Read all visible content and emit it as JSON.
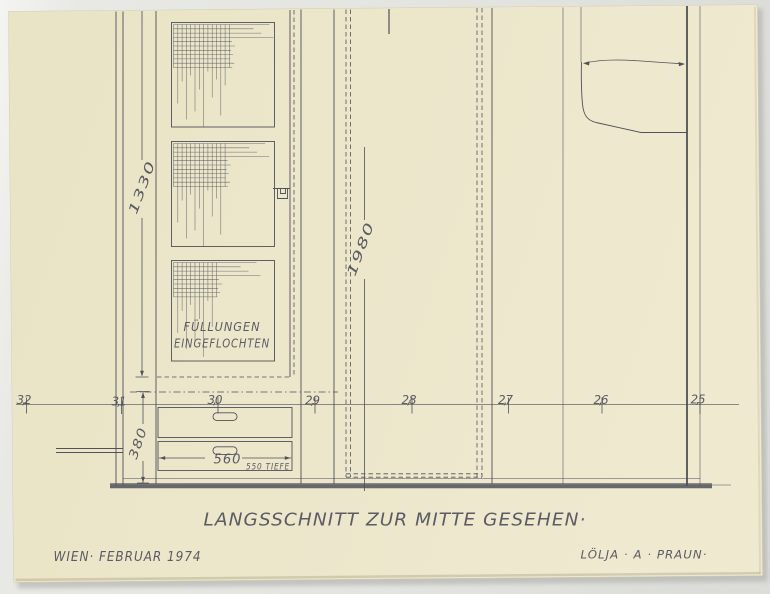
{
  "sheet": {
    "title": "LANGSSCHNITT ZUR MITTE GESEHEN·",
    "place_date": "WIEN· FEBRUAR 1974",
    "signature": "LÖLJA · A · PRAUN·",
    "panel_note_line1": "FÜLLUNGEN",
    "panel_note_line2": "EINGEFLOCHTEN",
    "dimensions": {
      "door_height": "1330",
      "total_height": "1980",
      "drawer_section_height": "380",
      "drawer_width": "560",
      "depth_note": "550 TIEFE"
    },
    "axis_marks": [
      "3,2",
      "3,1",
      "3,0",
      "2,9",
      "2,8",
      "2,7",
      "2,6",
      "2,5"
    ],
    "colors": {
      "paper": "#ece6ca",
      "ink": "#4f515b",
      "background": "#e5e6e2",
      "floor": "#8e8f93"
    }
  }
}
